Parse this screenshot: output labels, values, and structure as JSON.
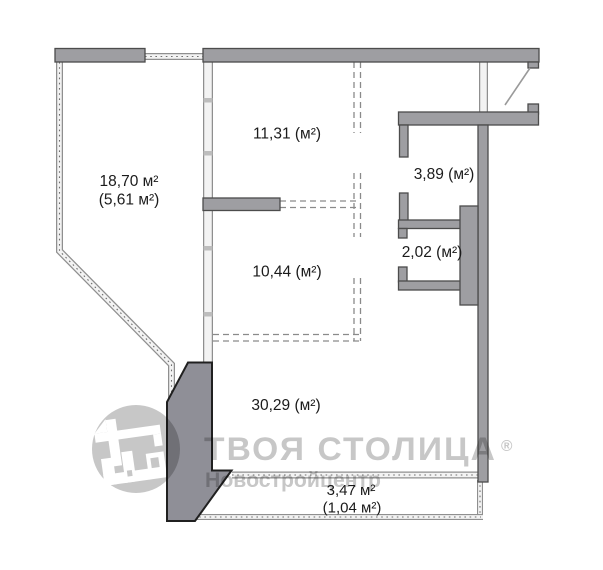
{
  "rooms": {
    "room_top": "11,31 (м²)",
    "room_mid": "10,44 (м²)",
    "room_living": "30,29 (м²)",
    "bathroom": "3,89 (м²)",
    "wc": "2,02 (м²)",
    "loggia": {
      "total": "18,70 м²",
      "reduced": "(5,61 м²)"
    },
    "balcony": {
      "total": "3,47 м²",
      "reduced": "(1,04 м²)"
    }
  },
  "watermark": {
    "brand": "ТВОЯ СТОЛИЦА",
    "registered_mark": "®",
    "subtitle": "Новостройцентр"
  },
  "colors": {
    "wall_fill": "#9e9ea2",
    "heavy_wall_fill": "#8f8f97",
    "watermark_gray": "#c7c7c7",
    "label_text": "#1b1b1b"
  }
}
